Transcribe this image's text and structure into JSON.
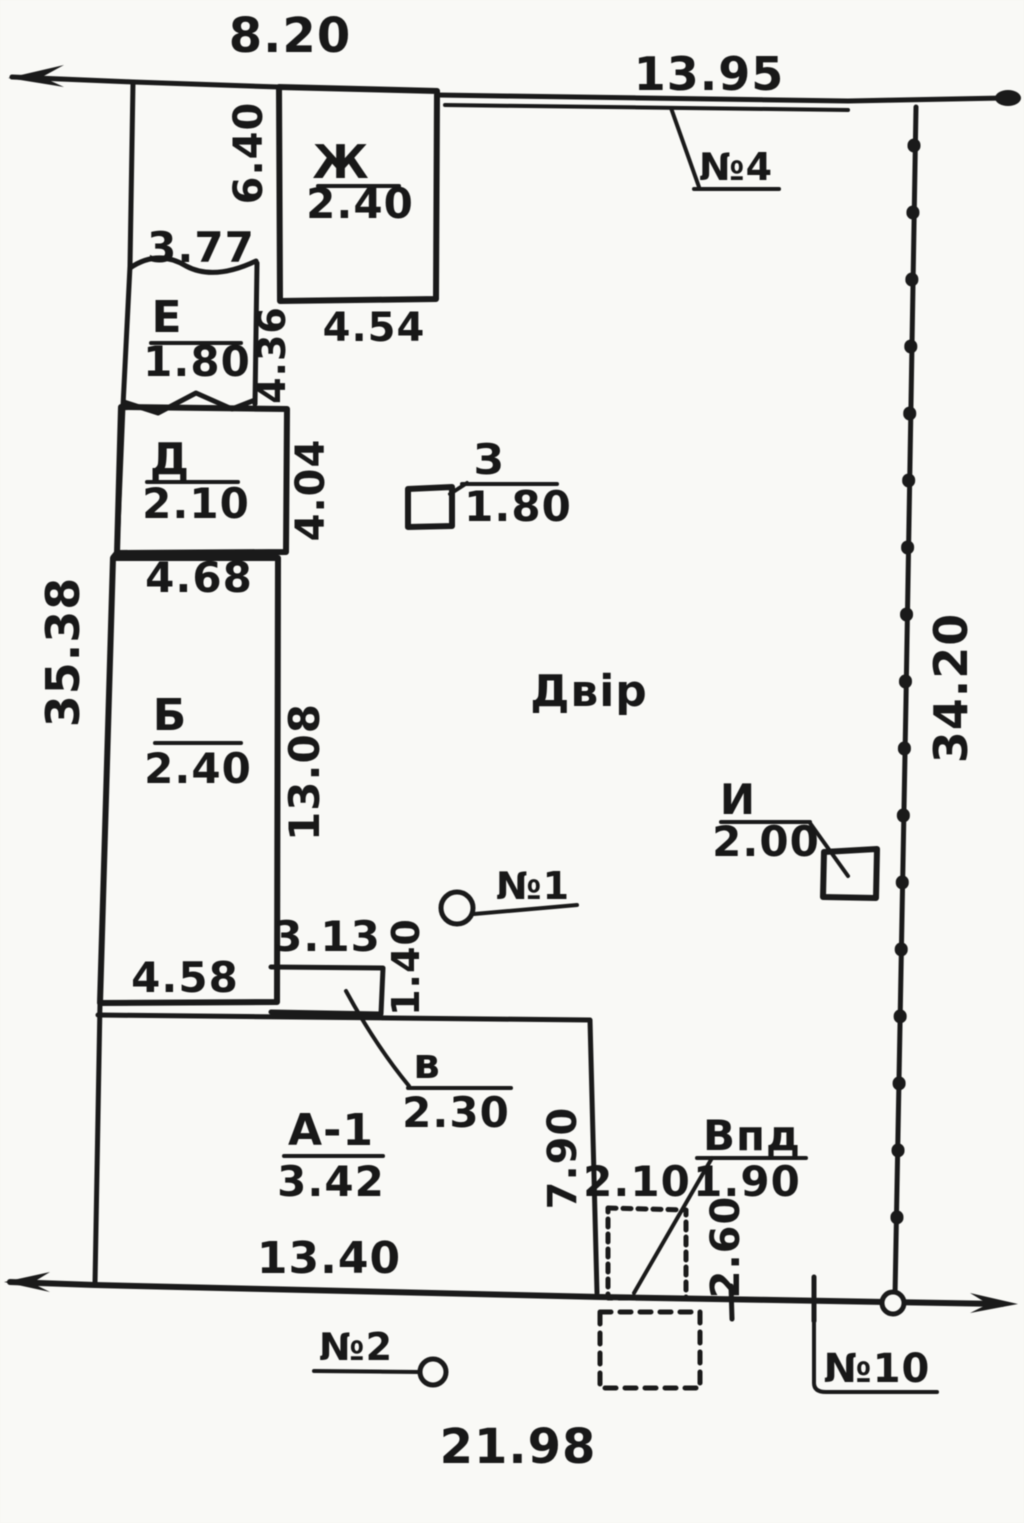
{
  "plot": {
    "yard_label": "Двір",
    "dims": {
      "top_width": "8.20",
      "street_front": "13.95",
      "left_side": "35.38",
      "right_side": "34.20",
      "bottom_width": "21.98",
      "shed_gap": "3.77",
      "zh_side": "6.40",
      "zh_width": "4.54",
      "e_zh_gap": "4.36",
      "d_side": "4.04",
      "d_width": "4.68",
      "b_side": "13.08",
      "b_width": "4.58",
      "annex_width": "3.13",
      "annex_depth": "1.40",
      "a1_width": "13.40",
      "a1_side": "7.90",
      "vpd_offset": "2.10",
      "vpd_side": "2.60"
    },
    "buildings": {
      "zh": {
        "letter": "Ж",
        "value": "2.40"
      },
      "e": {
        "letter": "Е",
        "value": "1.80"
      },
      "d": {
        "letter": "Д",
        "value": "2.10"
      },
      "b": {
        "letter": "Б",
        "value": "2.40"
      },
      "a1": {
        "letter": "А-1",
        "value": "3.42"
      },
      "z": {
        "letter": "З",
        "value": "1.80"
      },
      "i": {
        "letter": "И",
        "value": "2.00"
      },
      "v": {
        "letter": "в",
        "value": "2.30"
      },
      "vpd": {
        "letter": "Впд",
        "value": "1.90"
      }
    },
    "points": {
      "p1": "№1",
      "p2": "№2",
      "p4": "№4",
      "p10": "№10"
    },
    "colors": {
      "ink": "#1c1c1c",
      "paper": "#f4f4f1"
    }
  }
}
